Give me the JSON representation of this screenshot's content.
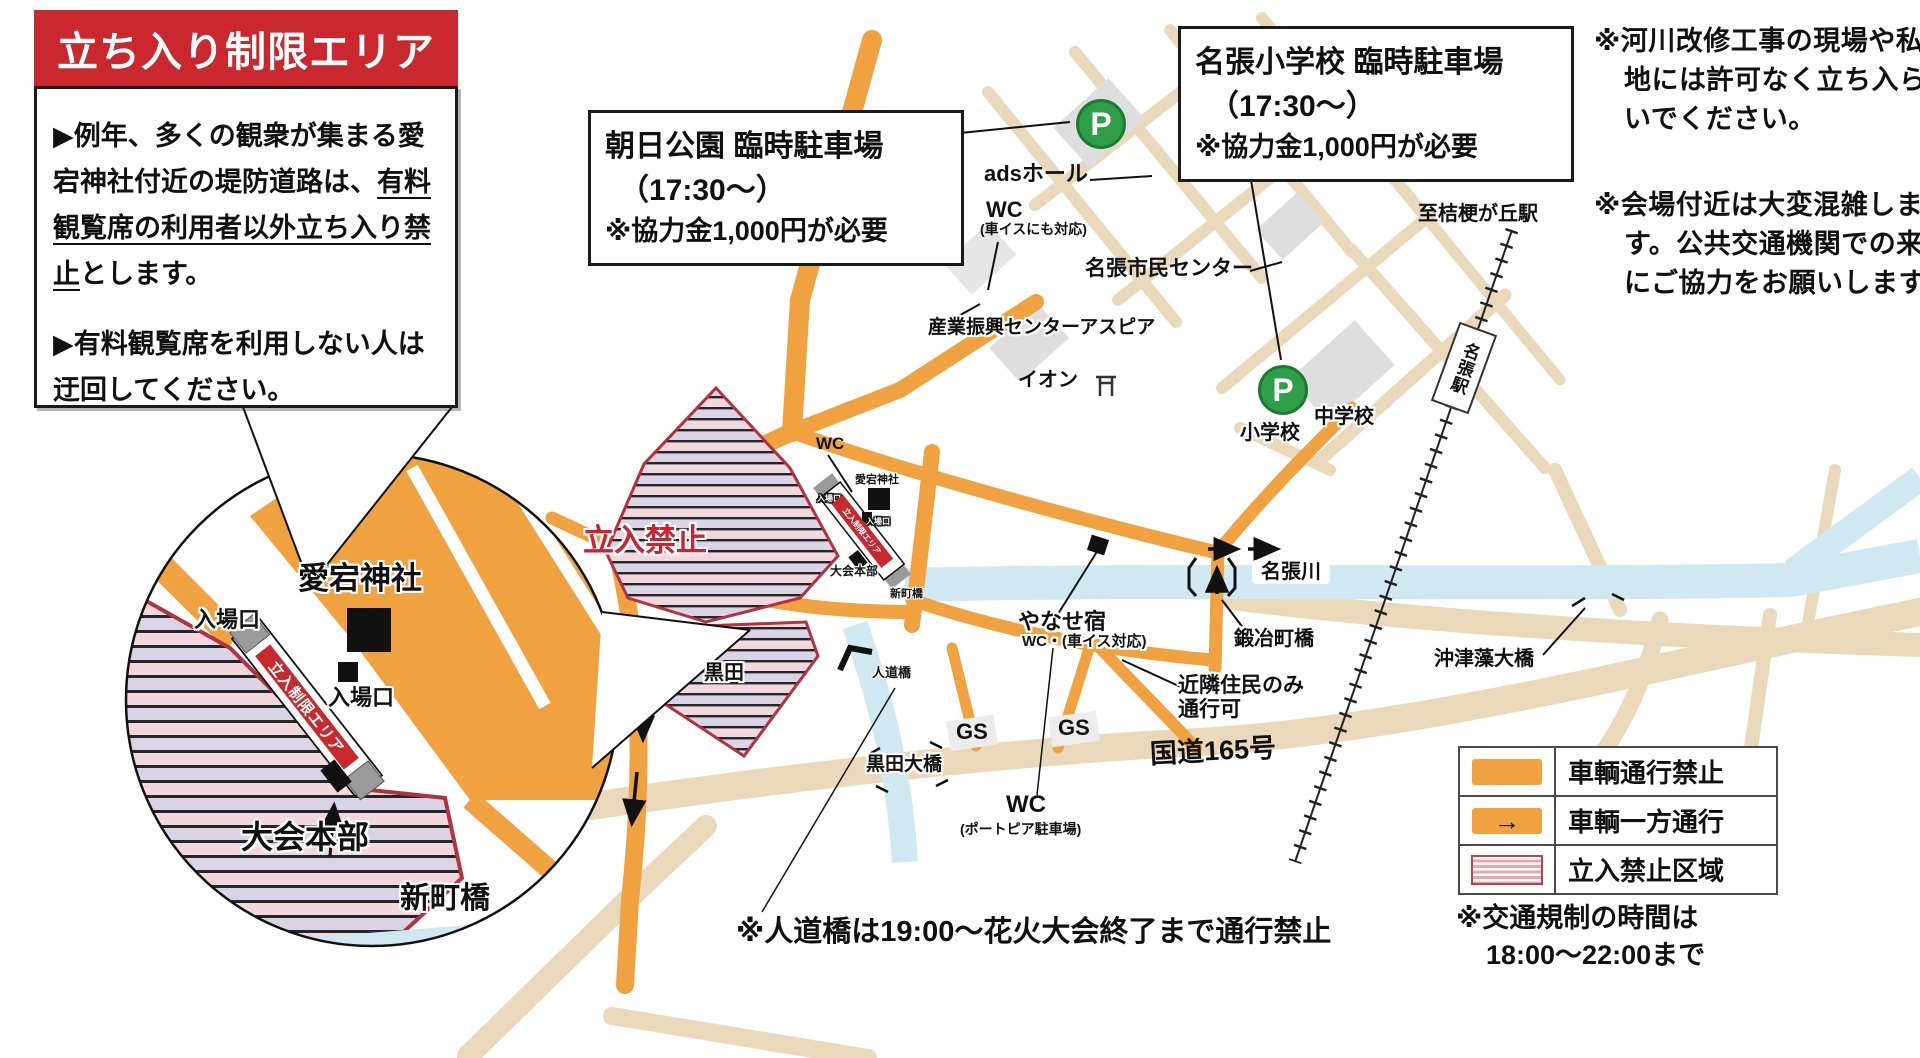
{
  "colors": {
    "accent_red": "#c8282e",
    "road_closed_orange": "#f0a140",
    "road_beige": "#e9d9ba",
    "river_blue": "#cfe8f2",
    "parking_green": "#2f9e48",
    "no_entry_border": "#b13340"
  },
  "info_box": {
    "title": "立ち入り制限エリア",
    "bullet1_lead": "▶例年、多くの観衆が集まる愛宕神社付近の堤防道路は、",
    "bullet1_underline": "有料観覧席の利用者以外立ち入り禁止",
    "bullet1_tail": "とします。",
    "bullet2": "▶有料観覧席を利用しない人は迂回してください。"
  },
  "parking_boxes": {
    "asahi": {
      "line1": "朝日公園 臨時駐車場",
      "line2": "（17:30～）",
      "line3": "※協力金1,000円が必要"
    },
    "nabari_sho": {
      "line1": "名張小学校 臨時駐車場",
      "line2": "（17:30～）",
      "line3": "※協力金1,000円が必要"
    }
  },
  "notes_right": {
    "note1": "※河川改修工事の現場や私有地には許可なく立ち入らないでください。",
    "note2": "※会場付近は大変混雑します。公共交通機関での来場にご協力をお願いします。"
  },
  "legend": {
    "rows": [
      {
        "label": "車輌通行禁止"
      },
      {
        "label": "車輌一方通行"
      },
      {
        "label": "立入禁止区域"
      }
    ],
    "arrow_glyph": "→",
    "note_line1": "※交通規制の時間は",
    "note_line2": "18:00～22:00まで"
  },
  "bottom_note": "※人道橋は19:00～花火大会終了まで通行禁止",
  "map": {
    "p": "P",
    "wc": "WC",
    "gs": "GS",
    "ads_hall": "adsホール",
    "wc_main_sub": "(車イスにも対応)",
    "shimin_center": "名張市民センター",
    "sangyo_center": "産業振興センターアスピア",
    "aeon": "イオン",
    "to_kikyogaoka": "至桔梗が丘駅",
    "nabari_station": "名張駅",
    "shogakko": "小学校",
    "chugakko": "中学校",
    "atago_jinja": "愛宕神社",
    "nyujoguchi": "入場口",
    "restricted_banner": "立入制限エリア",
    "tachiiri_kinshi": "立入禁止",
    "taikai_honbu": "大会本部",
    "shinmachi_bashi": "新町橋",
    "kuroda": "黒田",
    "jindo_bashi": "人道橋",
    "kuroda_ohashi": "黒田大橋",
    "yanase_juku": "やなせ宿",
    "yanase_juku_sub": "WC・(車イス対応)",
    "kajicho_bashi": "鍛冶町橋",
    "kinrin_line1": "近隣住民のみ",
    "kinrin_line2": "通行可",
    "nabari_gawa": "名張川",
    "okitsumo_ohashi": "沖津藻大橋",
    "kokudo165": "国道165号",
    "wc_portopia_sub": "(ポートピア駐車場)"
  },
  "inset": {
    "atago_jinja": "愛宕神社",
    "nyujoguchi": "入場口",
    "restricted_banner": "立入制限エリア",
    "taikai_honbu": "大会本部",
    "shinmachi_bashi": "新町橋"
  }
}
